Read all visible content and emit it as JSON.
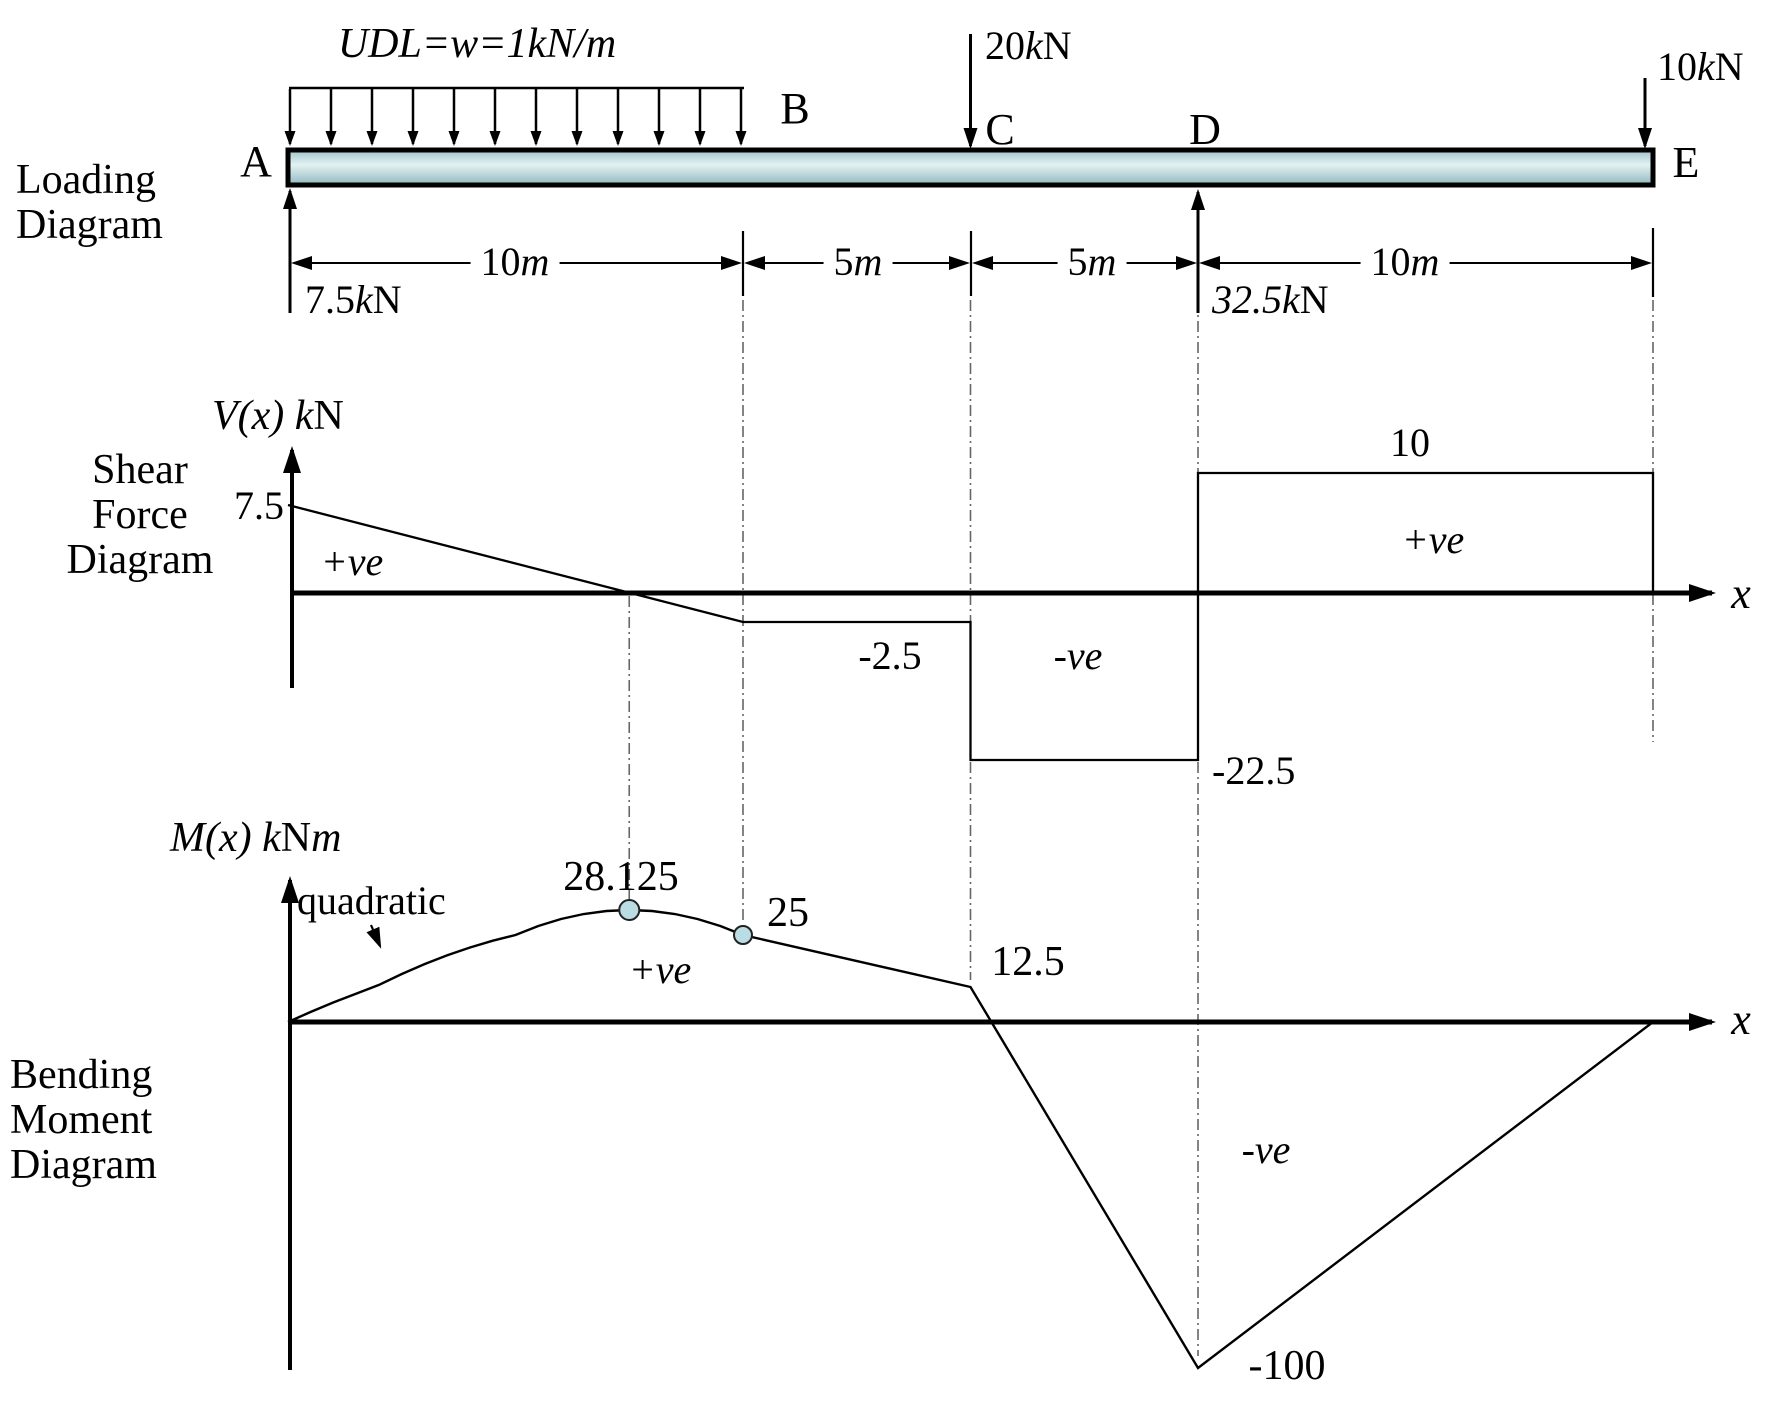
{
  "sections": {
    "loading": [
      "Loading",
      "Diagram"
    ],
    "shear": [
      "Shear",
      "Force",
      "Diagram"
    ],
    "moment": [
      "Bending",
      "Moment",
      "Diagram"
    ]
  },
  "beam": {
    "length_m": 30,
    "points": {
      "A": "A",
      "B": "B",
      "C": "C",
      "D": "D",
      "E": "E"
    },
    "points_m": {
      "A": 0,
      "B": 10,
      "C": 15,
      "D": 20,
      "E": 30
    },
    "udl": {
      "from_m": 0,
      "to_m": 10,
      "w_kN_per_m": 1,
      "label": [
        {
          "t": "UDL=w=1kN/m",
          "i": 1
        }
      ]
    },
    "dims": [
      {
        "from": "A",
        "to": "B",
        "label": [
          {
            "t": "10"
          },
          {
            "t": "m",
            "i": 1
          }
        ]
      },
      {
        "from": "B",
        "to": "C",
        "label": [
          {
            "t": "5"
          },
          {
            "t": "m",
            "i": 1
          }
        ]
      },
      {
        "from": "C",
        "to": "D",
        "label": [
          {
            "t": "5"
          },
          {
            "t": "m",
            "i": 1
          }
        ]
      },
      {
        "from": "D",
        "to": "E",
        "label": [
          {
            "t": "10"
          },
          {
            "t": "m",
            "i": 1
          }
        ]
      }
    ],
    "loads": {
      "c": [
        {
          "t": "20"
        },
        {
          "t": "k",
          "i": 1
        },
        {
          "t": "N"
        }
      ],
      "e": [
        {
          "t": "10"
        },
        {
          "t": "k",
          "i": 1
        },
        {
          "t": "N"
        }
      ]
    },
    "reactions": {
      "a": [
        {
          "t": "7.5"
        },
        {
          "t": "k",
          "i": 1
        },
        {
          "t": "N"
        }
      ],
      "d": [
        {
          "t": "32.5",
          "i": 1
        },
        {
          "t": "k",
          "i": 1
        },
        {
          "t": "N"
        }
      ]
    }
  },
  "shear_labels": {
    "axis": [
      {
        "t": "V(x) ",
        "i": 1
      },
      {
        "t": "k",
        "i": 1
      },
      {
        "t": "N"
      }
    ],
    "x_axis": [
      {
        "t": "x",
        "i": 1
      }
    ],
    "v_at_A": "7.5",
    "pos1": [
      {
        "t": "+ve",
        "i": 1
      }
    ],
    "v_BC": "-2.5",
    "neg": [
      {
        "t": "-ve",
        "i": 1
      }
    ],
    "v_CD": "-22.5",
    "v_DE": "10",
    "pos2": [
      {
        "t": "+ve",
        "i": 1
      }
    ]
  },
  "moment_labels": {
    "axis": [
      {
        "t": "M(x) ",
        "i": 1
      },
      {
        "t": "k",
        "i": 1
      },
      {
        "t": "N"
      },
      {
        "t": "m",
        "i": 1
      }
    ],
    "x_axis": [
      {
        "t": "x",
        "i": 1
      }
    ],
    "quadratic": "quadratic",
    "max": "28.125",
    "at_B": "25",
    "pos": [
      {
        "t": "+ve",
        "i": 1
      }
    ],
    "at_C": "12.5",
    "neg": [
      {
        "t": "-ve",
        "i": 1
      }
    ],
    "min": "-100"
  },
  "colors": {
    "beam_fill_top": "#9dc6cb",
    "beam_fill_mid": "#e3f2f3",
    "beam_fill_bottom": "#8fb8be",
    "marker_fill": "#b9dde2",
    "line": "#000000",
    "guide": "#666666"
  },
  "chart_data": [
    {
      "type": "line",
      "name": "shear-force-diagram",
      "title": "V(x) kN",
      "xlabel": "x (m)",
      "ylabel": "V (kN)",
      "x": [
        0,
        10,
        15,
        15,
        20,
        20,
        30,
        30
      ],
      "values": [
        7.5,
        -2.5,
        -2.5,
        -22.5,
        -22.5,
        10,
        10,
        0
      ],
      "annotations": {
        "v_at_A": 7.5,
        "zero_crossing_m": 7.5,
        "v_B_to_C": -2.5,
        "v_C_to_D": -22.5,
        "v_D_to_E": 10
      },
      "regions": [
        "+ve (A to 7.5 m)",
        "-ve (7.5 m to D)",
        "+ve (D to E)"
      ],
      "grid": false,
      "xlim": [
        0,
        30
      ],
      "ylim": [
        -22.5,
        10
      ]
    },
    {
      "type": "line",
      "name": "bending-moment-diagram",
      "title": "M(x) kNm",
      "xlabel": "x (m)",
      "ylabel": "M (kNm)",
      "segments": [
        {
          "from_m": 0,
          "to_m": 10,
          "shape": "quadratic",
          "formula": "M = 7.5x - 0.5x^2",
          "c1": 7.5,
          "c2": -0.5
        },
        {
          "from_m": 10,
          "to_m": 15,
          "shape": "linear"
        },
        {
          "from_m": 15,
          "to_m": 20,
          "shape": "linear"
        },
        {
          "from_m": 20,
          "to_m": 30,
          "shape": "linear"
        }
      ],
      "points": [
        {
          "x_m": 0,
          "M": 0
        },
        {
          "x_m": 7.5,
          "M": 28.125
        },
        {
          "x_m": 10,
          "M": 25
        },
        {
          "x_m": 15,
          "M": 12.5
        },
        {
          "x_m": 20,
          "M": -100
        },
        {
          "x_m": 30,
          "M": 0
        }
      ],
      "regions": [
        "+ve (0 to ~16 m)",
        "-ve (~16 m to E)"
      ],
      "grid": false,
      "xlim": [
        0,
        30
      ],
      "ylim": [
        -100,
        28.125
      ]
    }
  ]
}
